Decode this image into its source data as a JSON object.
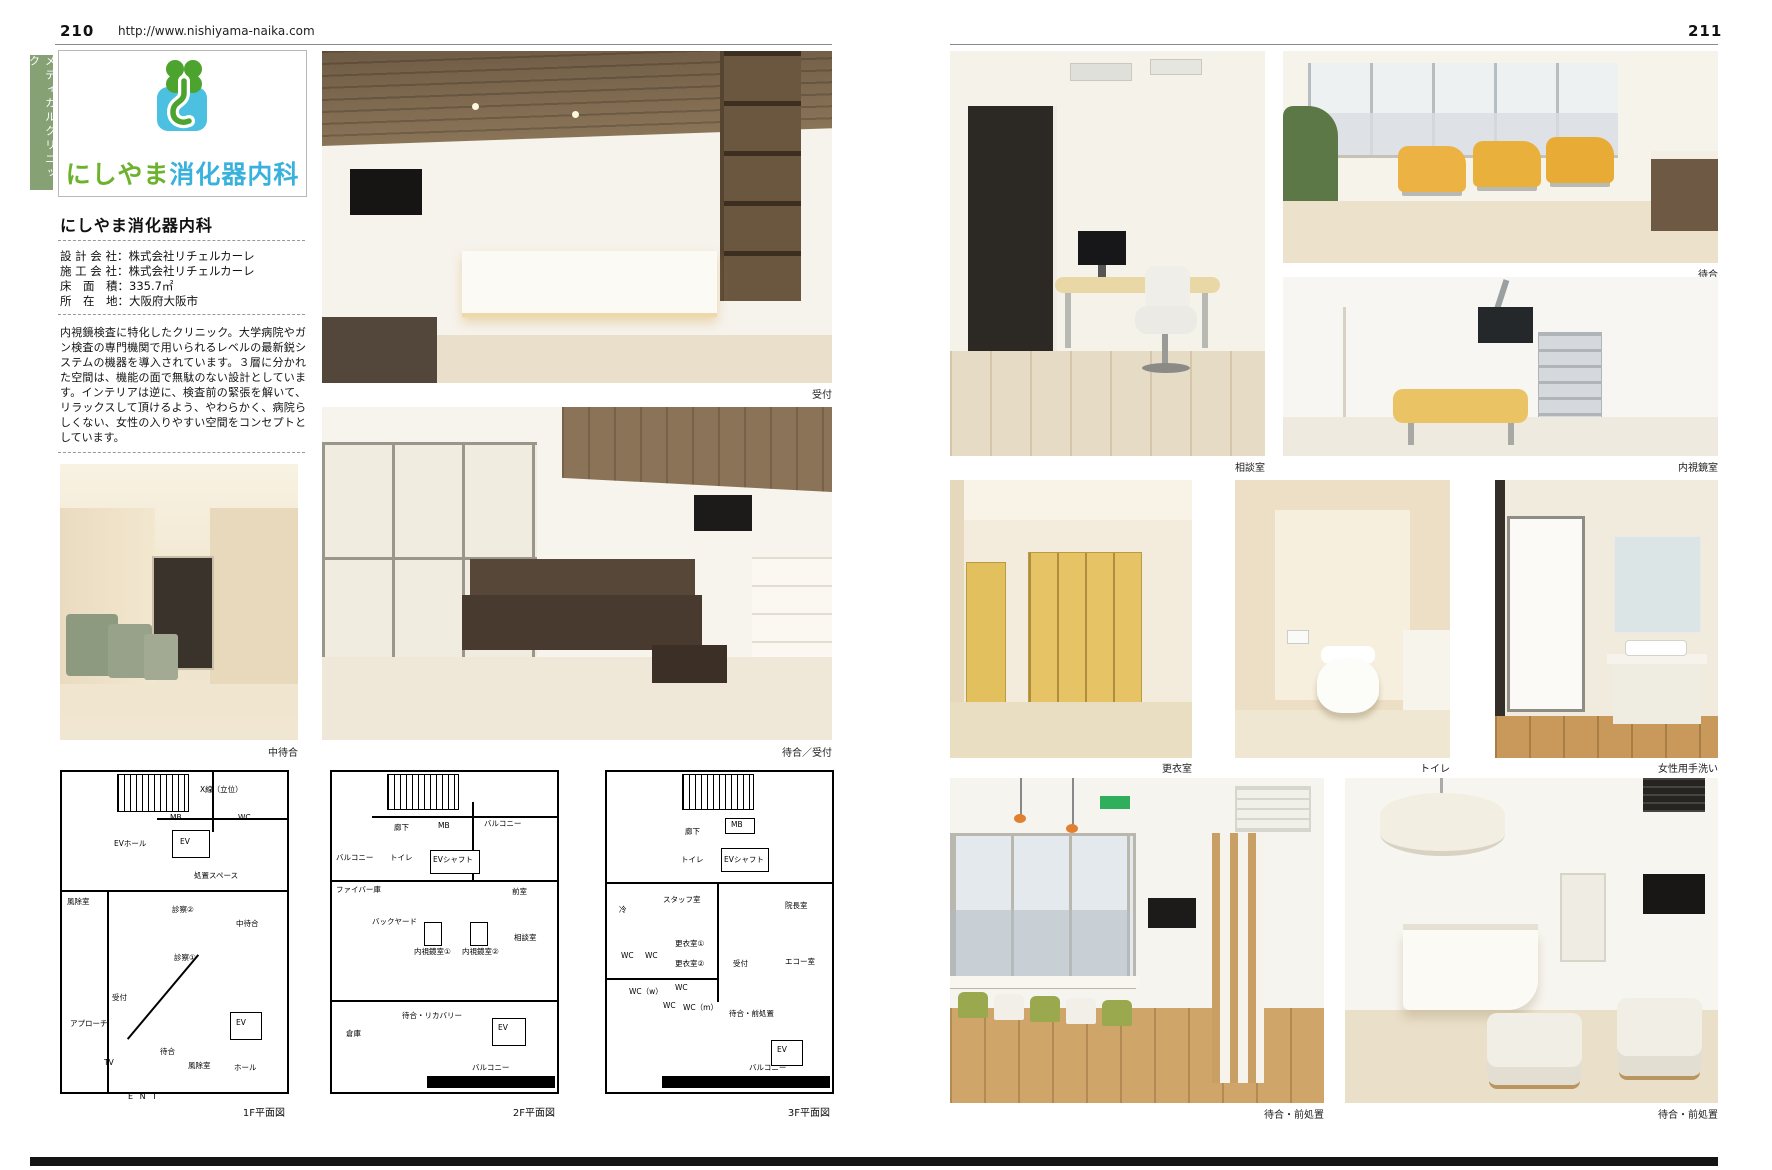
{
  "header_left": {
    "page_no": "210",
    "url": "http://www.nishiyama-naika.com"
  },
  "header_right": {
    "page_no": "211"
  },
  "category_tab": "メディカルクリニック",
  "logo": {
    "text_green": "にしやま",
    "text_blue": "消化器内科"
  },
  "colors": {
    "brand_green": "#6cb22c",
    "brand_blue": "#38b2dd",
    "tab_green": "#86a275",
    "locker_yellow": "#e6c466"
  },
  "clinic": {
    "title": "にしやま消化器内科",
    "info": [
      {
        "label": "設 計 会 社：",
        "value": "株式会社リチェルカーレ"
      },
      {
        "label": "施 工 会 社：",
        "value": "株式会社リチェルカーレ"
      },
      {
        "label": "床　面　積：",
        "value": "335.7㎡"
      },
      {
        "label": "所　在　地：",
        "value": "大阪府大阪市"
      }
    ],
    "description": "内視鏡検査に特化したクリニック。大学病院やガン検査の専門機関で用いられるレベルの最新鋭システムの機器を導入されています。３層に分かれた空間は、機能の面で無駄のない設計としています。インテリアは逆に、検査前の緊張を解いて、リラックスして頂けるよう、やわらかく、病院らしくない、女性の入りやすい空間をコンセプトとしています。"
  },
  "captions": {
    "reception": "受付",
    "waiting_reception": "待合／受付",
    "mid_waiting": "中待合",
    "consult_room": "相談室",
    "waiting": "待合",
    "endoscopy_room": "内視鏡室",
    "changing_room": "更衣室",
    "toilet": "トイレ",
    "ladies_washroom": "女性用手洗い",
    "waiting_pretreat_left": "待合・前処置",
    "waiting_pretreat_right": "待合・前処置"
  },
  "floorplans": {
    "ent": "E N T",
    "f1": {
      "caption": "1F平面図",
      "labels": [
        "X線（立位）",
        "MB",
        "WC",
        "EVホール",
        "EV",
        "処置スペース",
        "風除室",
        "診察②",
        "中待合",
        "診察①",
        "受付",
        "アプローチ",
        "待合",
        "TV",
        "風除室",
        "ホール",
        "EV"
      ]
    },
    "f2": {
      "caption": "2F平面図",
      "labels": [
        "バルコニー",
        "廊下",
        "MB",
        "バルコニー",
        "トイレ",
        "EVシャフト",
        "ファイバー庫",
        "前室",
        "バックヤード",
        "内視鏡室①",
        "内視鏡室②",
        "相談室",
        "待合・リカバリー",
        "倉庫",
        "EV",
        "バルコニー"
      ]
    },
    "f3": {
      "caption": "3F平面図",
      "labels": [
        "廊下",
        "MB",
        "トイレ",
        "EVシャフト",
        "スタッフ室",
        "冷",
        "院長室",
        "更衣室①",
        "更衣室②",
        "WC",
        "WC",
        "受付",
        "エコー室",
        "WC（w）",
        "WC",
        "WC",
        "WC（m）",
        "待合・前処置",
        "EV",
        "バルコニー"
      ]
    }
  }
}
